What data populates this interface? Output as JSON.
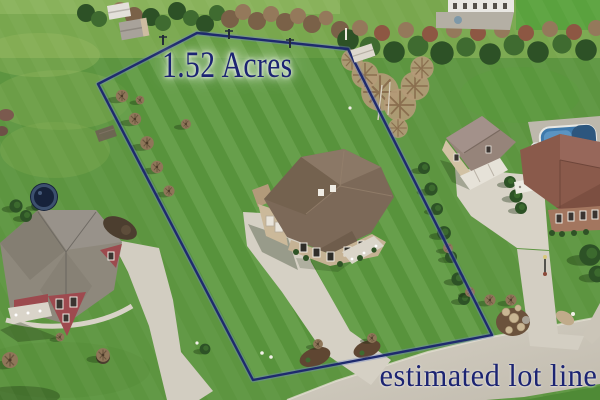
{
  "overlay": {
    "acreage_label": "1.52 Acres",
    "disclaimer_label": "estimated lot line"
  },
  "lot": {
    "polygon_points": "98,84 197,33 348,49 492,335 253,380"
  },
  "colors": {
    "lot_line": "#1e2a6e",
    "lot_line_glow": "#7286c9",
    "label_text": "#1c2472",
    "lawn": "#578f3a",
    "outer_field": "#79a74e",
    "road_concrete": "#cec8bb",
    "driveway_concrete": "#d5d0c4",
    "main_house_roof": "#7c6958",
    "main_house_wall": "#c5b294",
    "left_house_roof": "#8e887c",
    "left_house_wall": "#9e4a4f",
    "right_garage_roof": "#96847a",
    "far_house_roof": "#8a5a4b",
    "pool_water": "#3e79ac"
  }
}
